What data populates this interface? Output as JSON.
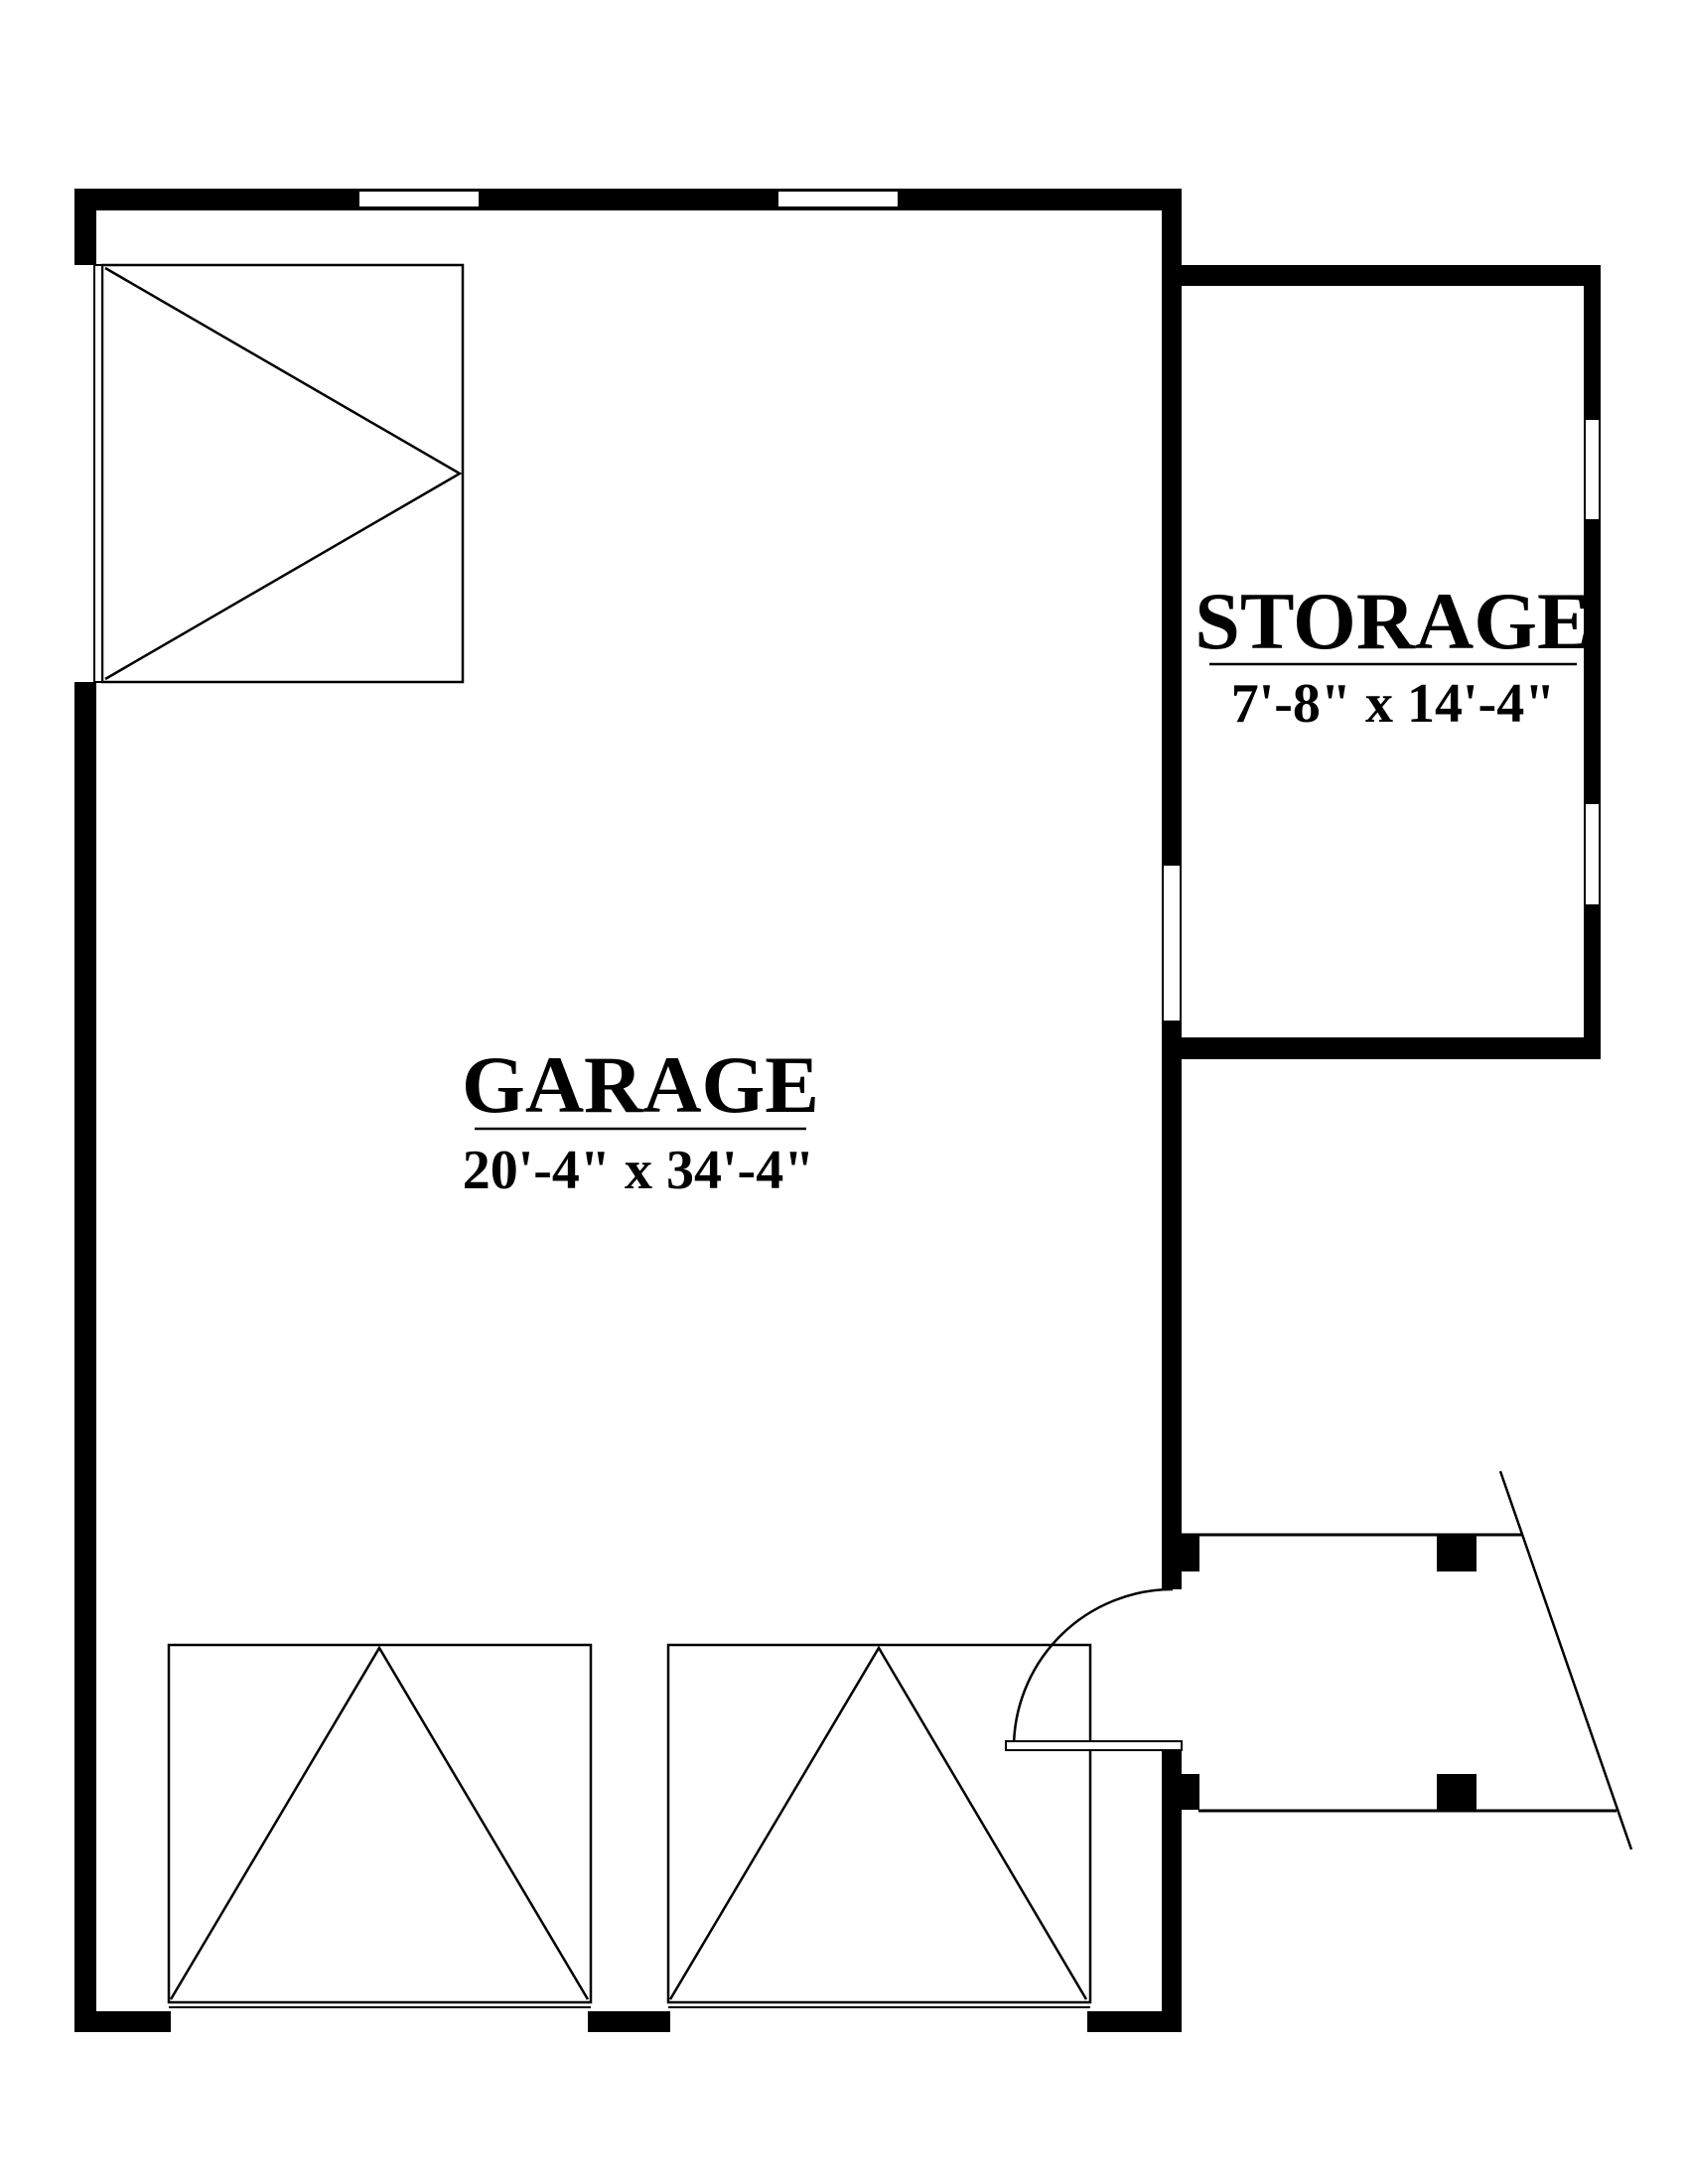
{
  "colors": {
    "background": "#ffffff",
    "line": "#000000"
  },
  "rooms": {
    "garage": {
      "label": "GARAGE",
      "dimensions": "20'-4\" x 34'-4\""
    },
    "storage": {
      "label": "STORAGE",
      "dimensions": "7'-8\" x 14'-4\""
    }
  }
}
